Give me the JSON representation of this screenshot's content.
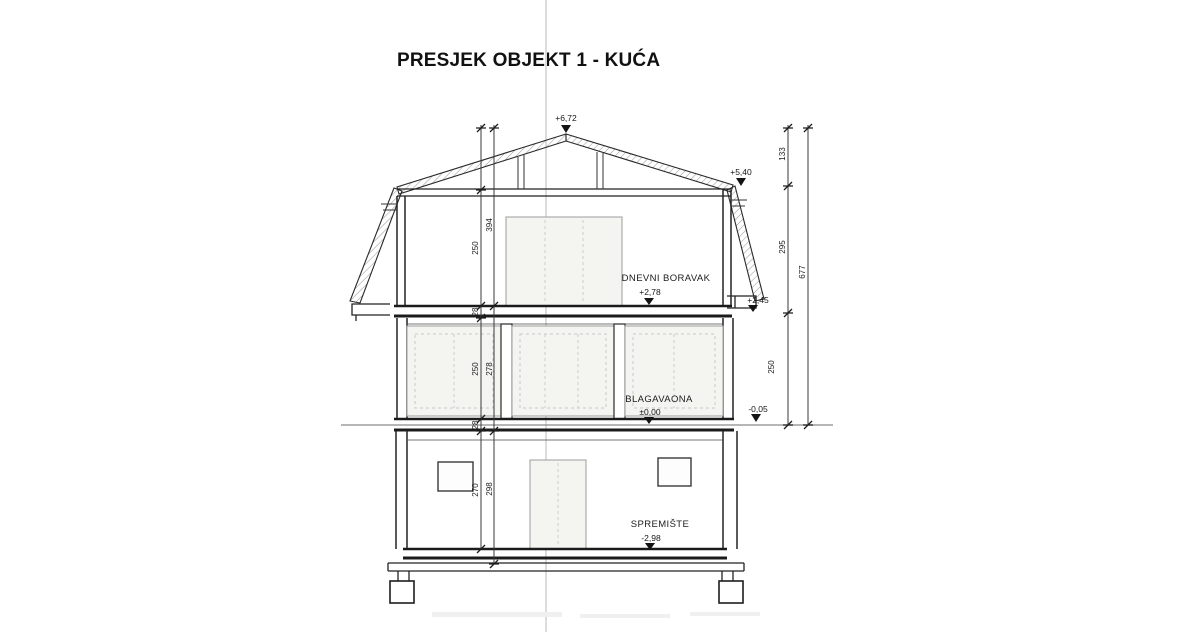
{
  "title": "PRESJEK OBJEKT 1 - KUĆA",
  "rooms": [
    {
      "name": "DNEVNI BORAVAK",
      "elevation": "+2,78"
    },
    {
      "name": "BLAGAVAONA",
      "elevation": "±0,00"
    },
    {
      "name": "SPREMIŠTE",
      "elevation": "-2,98"
    }
  ],
  "elevation_markers": {
    "ridge": "+6,72",
    "eave": "+5,40",
    "terrace": "+2,45",
    "ground": "-0,05"
  },
  "dimensions": {
    "left_inner": [
      "250",
      "28",
      "250",
      "28",
      "270"
    ],
    "left_outer": [
      "394",
      "278",
      "298"
    ],
    "right_segments": [
      "133",
      "295",
      "250"
    ],
    "right_total": "677"
  },
  "colors": {
    "ink": "#1f1f1f",
    "fold_line": "#dcdcdc",
    "panel_fill": "#f4f4f1"
  }
}
